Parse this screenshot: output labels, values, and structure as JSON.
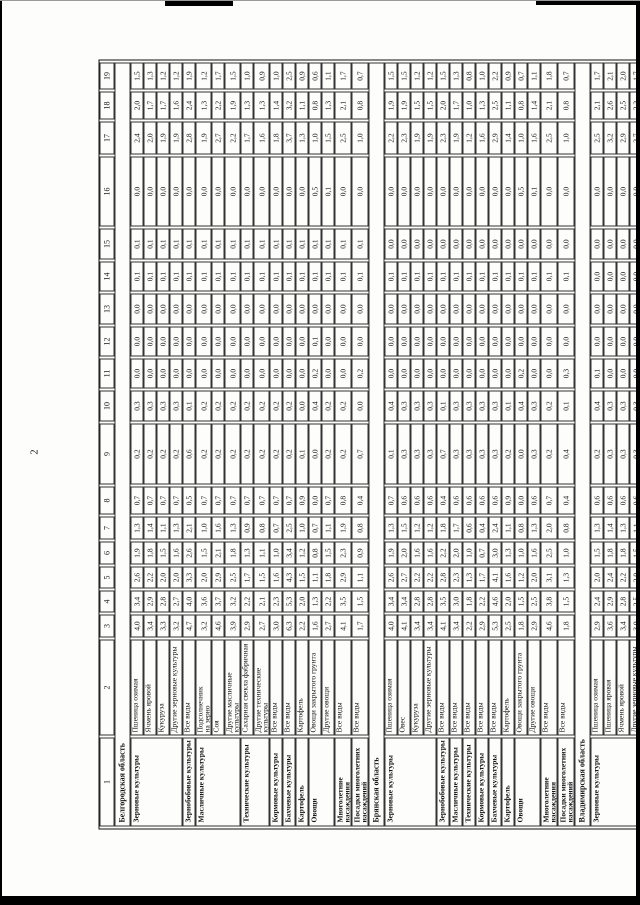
{
  "page": {
    "number": "2"
  },
  "table": {
    "col_widths": [
      89,
      96,
      23,
      22,
      22,
      23,
      23,
      28,
      61,
      31,
      30,
      30,
      31,
      30,
      31,
      70,
      33,
      28,
      27
    ],
    "header_cols": [
      "1",
      "2",
      "3",
      "4",
      "5",
      "6",
      "7",
      "8",
      "9",
      "10",
      "11",
      "12",
      "13",
      "14",
      "15",
      "16",
      "17",
      "18",
      "19"
    ],
    "sections": [
      {
        "region": "Белгородская область",
        "groups": [
          {
            "label": "Зерновые культуры",
            "rows": [
              [
                "Пшеница озимая",
                "4,0",
                "3,4",
                "2,6",
                "1,9",
                "1,3",
                "0,7",
                "0,2",
                "0,3",
                "0,0",
                "0,0",
                "0,0",
                "0,1",
                "0,1",
                "0,0",
                "2,4",
                "2,0",
                "1,5"
              ],
              [
                "Ячмень яровой",
                "3,4",
                "2,9",
                "2,2",
                "1,8",
                "1,4",
                "0,7",
                "0,2",
                "0,3",
                "0,0",
                "0,0",
                "0,0",
                "0,1",
                "0,1",
                "0,0",
                "2,0",
                "1,7",
                "1,3"
              ],
              [
                "Кукуруза",
                "3,3",
                "2,8",
                "2,0",
                "1,5",
                "1,1",
                "0,7",
                "0,2",
                "0,3",
                "0,0",
                "0,0",
                "0,0",
                "0,1",
                "0,1",
                "0,0",
                "1,9",
                "1,7",
                "1,2"
              ],
              [
                "Другие зерновые культуры",
                "3,2",
                "2,7",
                "2,0",
                "1,6",
                "1,3",
                "0,7",
                "0,2",
                "0,3",
                "0,0",
                "0,0",
                "0,0",
                "0,1",
                "0,1",
                "0,0",
                "1,9",
                "1,6",
                "1,2"
              ]
            ]
          },
          {
            "label": "Зернобобовые культуры",
            "rows": [
              [
                "Все виды",
                "4,7",
                "4,0",
                "3,3",
                "2,6",
                "2,1",
                "0,5",
                "0,6",
                "0,1",
                "0,0",
                "0,0",
                "0,0",
                "0,1",
                "0,1",
                "0,0",
                "2,8",
                "2,4",
                "1,9"
              ]
            ]
          },
          {
            "label": "Масличные культуры",
            "rows": [
              [
                "Подсолнечник\nна зерно",
                "3,2",
                "3,6",
                "2,0",
                "1,5",
                "1,0",
                "0,7",
                "0,2",
                "0,2",
                "0,0",
                "0,0",
                "0,0",
                "0,1",
                "0,1",
                "0,0",
                "1,9",
                "1,3",
                "1,2"
              ],
              [
                "Соя",
                "4,6",
                "3,7",
                "2,9",
                "2,1",
                "1,6",
                "0,7",
                "0,2",
                "0,2",
                "0,0",
                "0,0",
                "0,0",
                "0,1",
                "0,1",
                "0,0",
                "2,7",
                "2,2",
                "1,7"
              ],
              [
                "Другие масличные культуры",
                "3,9",
                "3,2",
                "2,5",
                "1,8",
                "1,3",
                "0,7",
                "0,2",
                "0,2",
                "0,0",
                "0,0",
                "0,0",
                "0,1",
                "0,1",
                "0,0",
                "2,2",
                "1,9",
                "1,5"
              ]
            ]
          },
          {
            "label": "Технические культуры",
            "rows": [
              [
                "Сахарная свекла фабричная",
                "2,9",
                "2,2",
                "1,7",
                "1,3",
                "0,9",
                "0,7",
                "0,2",
                "0,2",
                "0,0",
                "0,0",
                "0,0",
                "0,1",
                "0,1",
                "0,0",
                "1,7",
                "1,3",
                "1,0"
              ],
              [
                "Другие технические культуры",
                "2,7",
                "2,1",
                "1,5",
                "1,1",
                "0,8",
                "0,7",
                "0,2",
                "0,2",
                "0,0",
                "0,0",
                "0,0",
                "0,1",
                "0,1",
                "0,0",
                "1,6",
                "1,3",
                "0,9"
              ]
            ]
          },
          {
            "label": "Кормовые культуры",
            "rows": [
              [
                "Все виды",
                "3,0",
                "2,3",
                "1,6",
                "1,0",
                "0,7",
                "0,7",
                "0,2",
                "0,2",
                "0,0",
                "0,0",
                "0,0",
                "0,1",
                "0,1",
                "0,0",
                "1,8",
                "1,4",
                "1,0"
              ]
            ]
          },
          {
            "label": "Бахчевые культуры",
            "rows": [
              [
                "Все виды",
                "6,3",
                "5,3",
                "4,3",
                "3,4",
                "2,5",
                "0,7",
                "0,2",
                "0,2",
                "0,0",
                "0,0",
                "0,0",
                "0,1",
                "0,1",
                "0,0",
                "3,7",
                "3,2",
                "2,5"
              ]
            ]
          },
          {
            "label": "Картофель",
            "rows": [
              [
                "Картофель",
                "2,2",
                "2,0",
                "1,5",
                "1,2",
                "1,0",
                "0,9",
                "0,1",
                "0,0",
                "0,0",
                "0,0",
                "0,0",
                "0,1",
                "0,1",
                "0,0",
                "1,3",
                "1,1",
                "0,9"
              ]
            ]
          },
          {
            "label": "Овощи",
            "rows": [
              [
                "Овощи закрытого грунта",
                "1,6",
                "1,3",
                "1,1",
                "0,8",
                "0,7",
                "0,0",
                "0,0",
                "0,4",
                "0,2",
                "0,1",
                "0,0",
                "0,1",
                "0,1",
                "0,5",
                "1,0",
                "0,8",
                "0,6"
              ],
              [
                "Другие овощи",
                "2,7",
                "2,2",
                "1,8",
                "1,5",
                "1,1",
                "0,7",
                "0,2",
                "0,2",
                "0,0",
                "0,0",
                "0,0",
                "0,1",
                "0,1",
                "0,1",
                "1,5",
                "1,3",
                "1,1"
              ]
            ]
          },
          {
            "label": "Многолетние насаждения",
            "rows": [
              [
                "Все виды",
                "4,1",
                "3,5",
                "2,9",
                "2,3",
                "1,9",
                "0,8",
                "0,2",
                "0,2",
                "0,0",
                "0,0",
                "0,0",
                "0,1",
                "0,1",
                "0,0",
                "2,5",
                "2,1",
                "1,7"
              ]
            ]
          },
          {
            "label": "Посадки многолетних насаждений",
            "rows": [
              [
                "Все виды",
                "1,7",
                "1,5",
                "1,1",
                "0,9",
                "0,8",
                "0,4",
                "0,7",
                "0,0",
                "0,2",
                "0,0",
                "0,0",
                "0,1",
                "0,1",
                "0,0",
                "1,0",
                "0,8",
                "0,7"
              ]
            ]
          }
        ]
      },
      {
        "region": "Брянская область",
        "groups": [
          {
            "label": "Зерновые культуры",
            "rows": [
              [
                "Пшеница озимая",
                "4,0",
                "3,4",
                "2,6",
                "1,9",
                "1,3",
                "0,7",
                "0,1",
                "0,4",
                "0,0",
                "0,0",
                "0,0",
                "0,1",
                "0,0",
                "0,0",
                "2,2",
                "1,9",
                "1,5"
              ],
              [
                "Овес",
                "4,1",
                "3,4",
                "2,7",
                "2,0",
                "1,5",
                "0,6",
                "0,3",
                "0,3",
                "0,0",
                "0,0",
                "0,0",
                "0,1",
                "0,0",
                "0,0",
                "2,3",
                "1,9",
                "1,5"
              ],
              [
                "Кукуруза",
                "3,4",
                "2,8",
                "2,2",
                "1,6",
                "1,2",
                "0,6",
                "0,3",
                "0,3",
                "0,0",
                "0,0",
                "0,0",
                "0,1",
                "0,0",
                "0,0",
                "1,9",
                "1,5",
                "1,2"
              ],
              [
                "Другие зерновые культуры",
                "3,4",
                "2,8",
                "2,2",
                "1,6",
                "1,2",
                "0,6",
                "0,3",
                "0,3",
                "0,0",
                "0,0",
                "0,0",
                "0,1",
                "0,0",
                "0,0",
                "1,9",
                "1,5",
                "1,2"
              ]
            ]
          },
          {
            "label": "Зернобобовые культуры",
            "rows": [
              [
                "Все виды",
                "4,1",
                "3,5",
                "2,8",
                "2,2",
                "1,8",
                "0,4",
                "0,7",
                "0,1",
                "0,0",
                "0,0",
                "0,0",
                "0,1",
                "0,0",
                "0,0",
                "2,3",
                "2,0",
                "1,5"
              ]
            ]
          },
          {
            "label": "Масличные культуры",
            "rows": [
              [
                "Все виды",
                "3,4",
                "3,0",
                "2,3",
                "2,0",
                "1,7",
                "0,6",
                "0,3",
                "0,3",
                "0,0",
                "0,0",
                "0,0",
                "0,1",
                "0,0",
                "0,0",
                "1,9",
                "1,7",
                "1,3"
              ]
            ]
          },
          {
            "label": "Технические культуры",
            "rows": [
              [
                "Все виды",
                "2,2",
                "1,8",
                "1,3",
                "1,0",
                "0,6",
                "0,6",
                "0,3",
                "0,3",
                "0,0",
                "0,0",
                "0,0",
                "0,1",
                "0,0",
                "0,0",
                "1,2",
                "1,0",
                "0,8"
              ]
            ]
          },
          {
            "label": "Кормовые культуры",
            "rows": [
              [
                "Все виды",
                "2,9",
                "2,2",
                "1,7",
                "0,7",
                "0,4",
                "0,6",
                "0,3",
                "0,3",
                "0,0",
                "0,0",
                "0,0",
                "0,1",
                "0,0",
                "0,0",
                "1,6",
                "1,3",
                "1,0"
              ]
            ]
          },
          {
            "label": "Бахчевые культуры",
            "rows": [
              [
                "Все виды",
                "5,3",
                "4,6",
                "4,1",
                "3,0",
                "2,4",
                "0,6",
                "0,3",
                "0,3",
                "0,0",
                "0,0",
                "0,0",
                "0,1",
                "0,0",
                "0,0",
                "2,9",
                "2,5",
                "2,2"
              ]
            ]
          },
          {
            "label": "Картофель",
            "rows": [
              [
                "Картофель",
                "2,5",
                "2,0",
                "1,6",
                "1,3",
                "1,1",
                "0,9",
                "0,2",
                "0,1",
                "0,0",
                "0,0",
                "0,0",
                "0,1",
                "0,0",
                "0,0",
                "1,4",
                "1,1",
                "0,9"
              ]
            ]
          },
          {
            "label": "Овощи",
            "rows": [
              [
                "Овощи закрытого грунта",
                "1,8",
                "1,5",
                "1,2",
                "1,0",
                "0,8",
                "0,0",
                "0,0",
                "0,4",
                "0,2",
                "0,0",
                "0,0",
                "0,1",
                "0,0",
                "0,5",
                "1,0",
                "0,8",
                "0,7"
              ],
              [
                "Другие овощи",
                "2,9",
                "2,5",
                "2,0",
                "1,6",
                "1,3",
                "0,6",
                "0,3",
                "0,3",
                "0,0",
                "0,0",
                "0,0",
                "0,1",
                "0,0",
                "0,1",
                "1,6",
                "1,4",
                "1,1"
              ]
            ]
          },
          {
            "label": "Многолетние насаждения",
            "rows": [
              [
                "Все виды",
                "4,6",
                "3,8",
                "3,1",
                "2,5",
                "2,0",
                "0,7",
                "0,2",
                "0,2",
                "0,0",
                "0,0",
                "0,0",
                "0,1",
                "0,0",
                "0,0",
                "2,5",
                "2,1",
                "1,8"
              ]
            ]
          },
          {
            "label": "Посадки многолетних насаждений",
            "rows": [
              [
                "Все виды",
                "1,8",
                "1,5",
                "1,3",
                "1,0",
                "0,8",
                "0,4",
                "0,4",
                "0,1",
                "0,3",
                "0,0",
                "0,0",
                "0,1",
                "0,0",
                "0,0",
                "1,0",
                "0,8",
                "0,7"
              ]
            ]
          }
        ]
      },
      {
        "region": "Владимирская область",
        "groups": [
          {
            "label": "Зерновые культуры",
            "rows": [
              [
                "Пшеница озимая",
                "2,9",
                "2,4",
                "2,0",
                "1,5",
                "1,3",
                "0,6",
                "0,2",
                "0,4",
                "0,1",
                "0,0",
                "0,0",
                "0,0",
                "0,0",
                "0,0",
                "2,5",
                "2,1",
                "1,7"
              ],
              [
                "Пшеница яровая",
                "3,6",
                "2,9",
                "2,4",
                "1,8",
                "1,4",
                "0,6",
                "0,3",
                "0,3",
                "0,0",
                "0,0",
                "0,0",
                "0,0",
                "0,0",
                "0,0",
                "3,2",
                "2,6",
                "2,1"
              ],
              [
                "Ячмень яровой",
                "3,4",
                "2,8",
                "2,2",
                "1,8",
                "1,3",
                "0,6",
                "0,3",
                "0,3",
                "0,0",
                "0,0",
                "0,0",
                "0,0",
                "0,0",
                "0,0",
                "2,9",
                "2,5",
                "2,0"
              ],
              [
                "Другие зерновые культуры",
                "3,0",
                "2,5",
                "2,0",
                "1,5",
                "1,1",
                "0,6",
                "0,3",
                "0,3",
                "0,0",
                "0,0",
                "0,0",
                "0,0",
                "0,0",
                "0,0",
                "2,7",
                "2,2",
                "1,7"
              ]
            ]
          }
        ]
      }
    ]
  }
}
